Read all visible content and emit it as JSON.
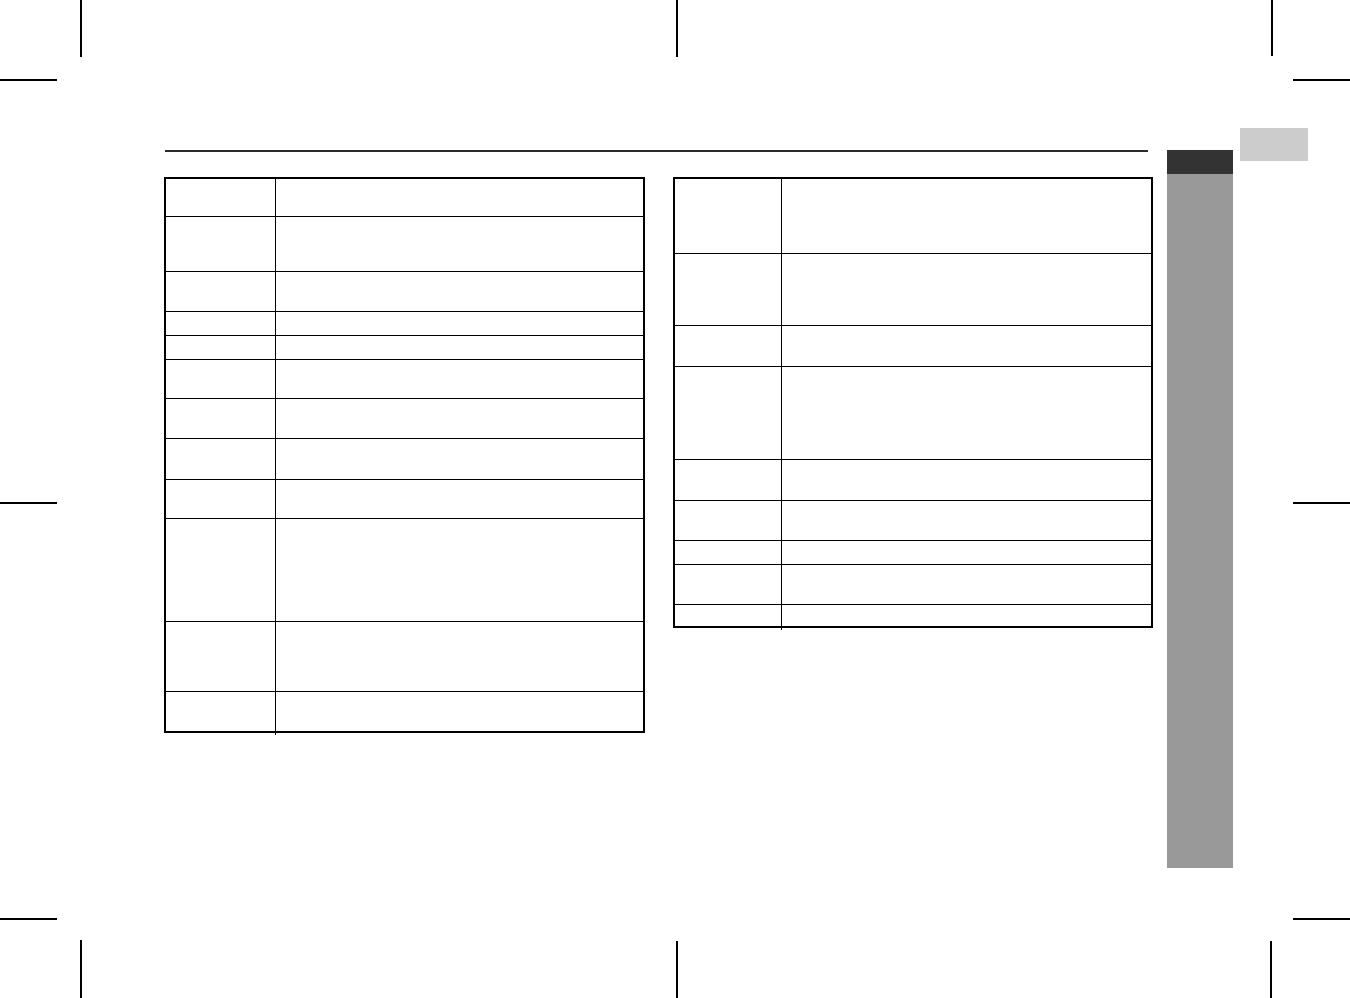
{
  "page": {
    "background": "#ffffff"
  },
  "colors": {
    "line": "#000000",
    "rule": "#2b2b2b",
    "section_tab": "#333333",
    "section_bar": "#999999",
    "corner_tab": "#cccccc",
    "page_bg": "#ffffff"
  },
  "left_table": {
    "rows": [
      {
        "height": 38,
        "term": "",
        "definition": ""
      },
      {
        "height": 55,
        "term": "",
        "definition": ""
      },
      {
        "height": 40,
        "term": "",
        "definition": ""
      },
      {
        "height": 24,
        "term": "",
        "definition": ""
      },
      {
        "height": 24,
        "term": "",
        "definition": ""
      },
      {
        "height": 39,
        "term": "",
        "definition": ""
      },
      {
        "height": 40,
        "term": "",
        "definition": ""
      },
      {
        "height": 41,
        "term": "",
        "definition": ""
      },
      {
        "height": 39,
        "term": "",
        "definition": ""
      },
      {
        "height": 103,
        "term": "",
        "definition": ""
      },
      {
        "height": 70,
        "term": "",
        "definition": ""
      },
      {
        "height": 43,
        "term": "",
        "definition": ""
      }
    ]
  },
  "right_table": {
    "rows": [
      {
        "height": 75,
        "term": "",
        "definition": ""
      },
      {
        "height": 72,
        "term": "",
        "definition": ""
      },
      {
        "height": 41,
        "term": "",
        "definition": ""
      },
      {
        "height": 93,
        "term": "",
        "definition": ""
      },
      {
        "height": 41,
        "term": "",
        "definition": ""
      },
      {
        "height": 40,
        "term": "",
        "definition": ""
      },
      {
        "height": 24,
        "term": "",
        "definition": ""
      },
      {
        "height": 40,
        "term": "",
        "definition": ""
      },
      {
        "height": 25,
        "term": "",
        "definition": ""
      }
    ]
  }
}
